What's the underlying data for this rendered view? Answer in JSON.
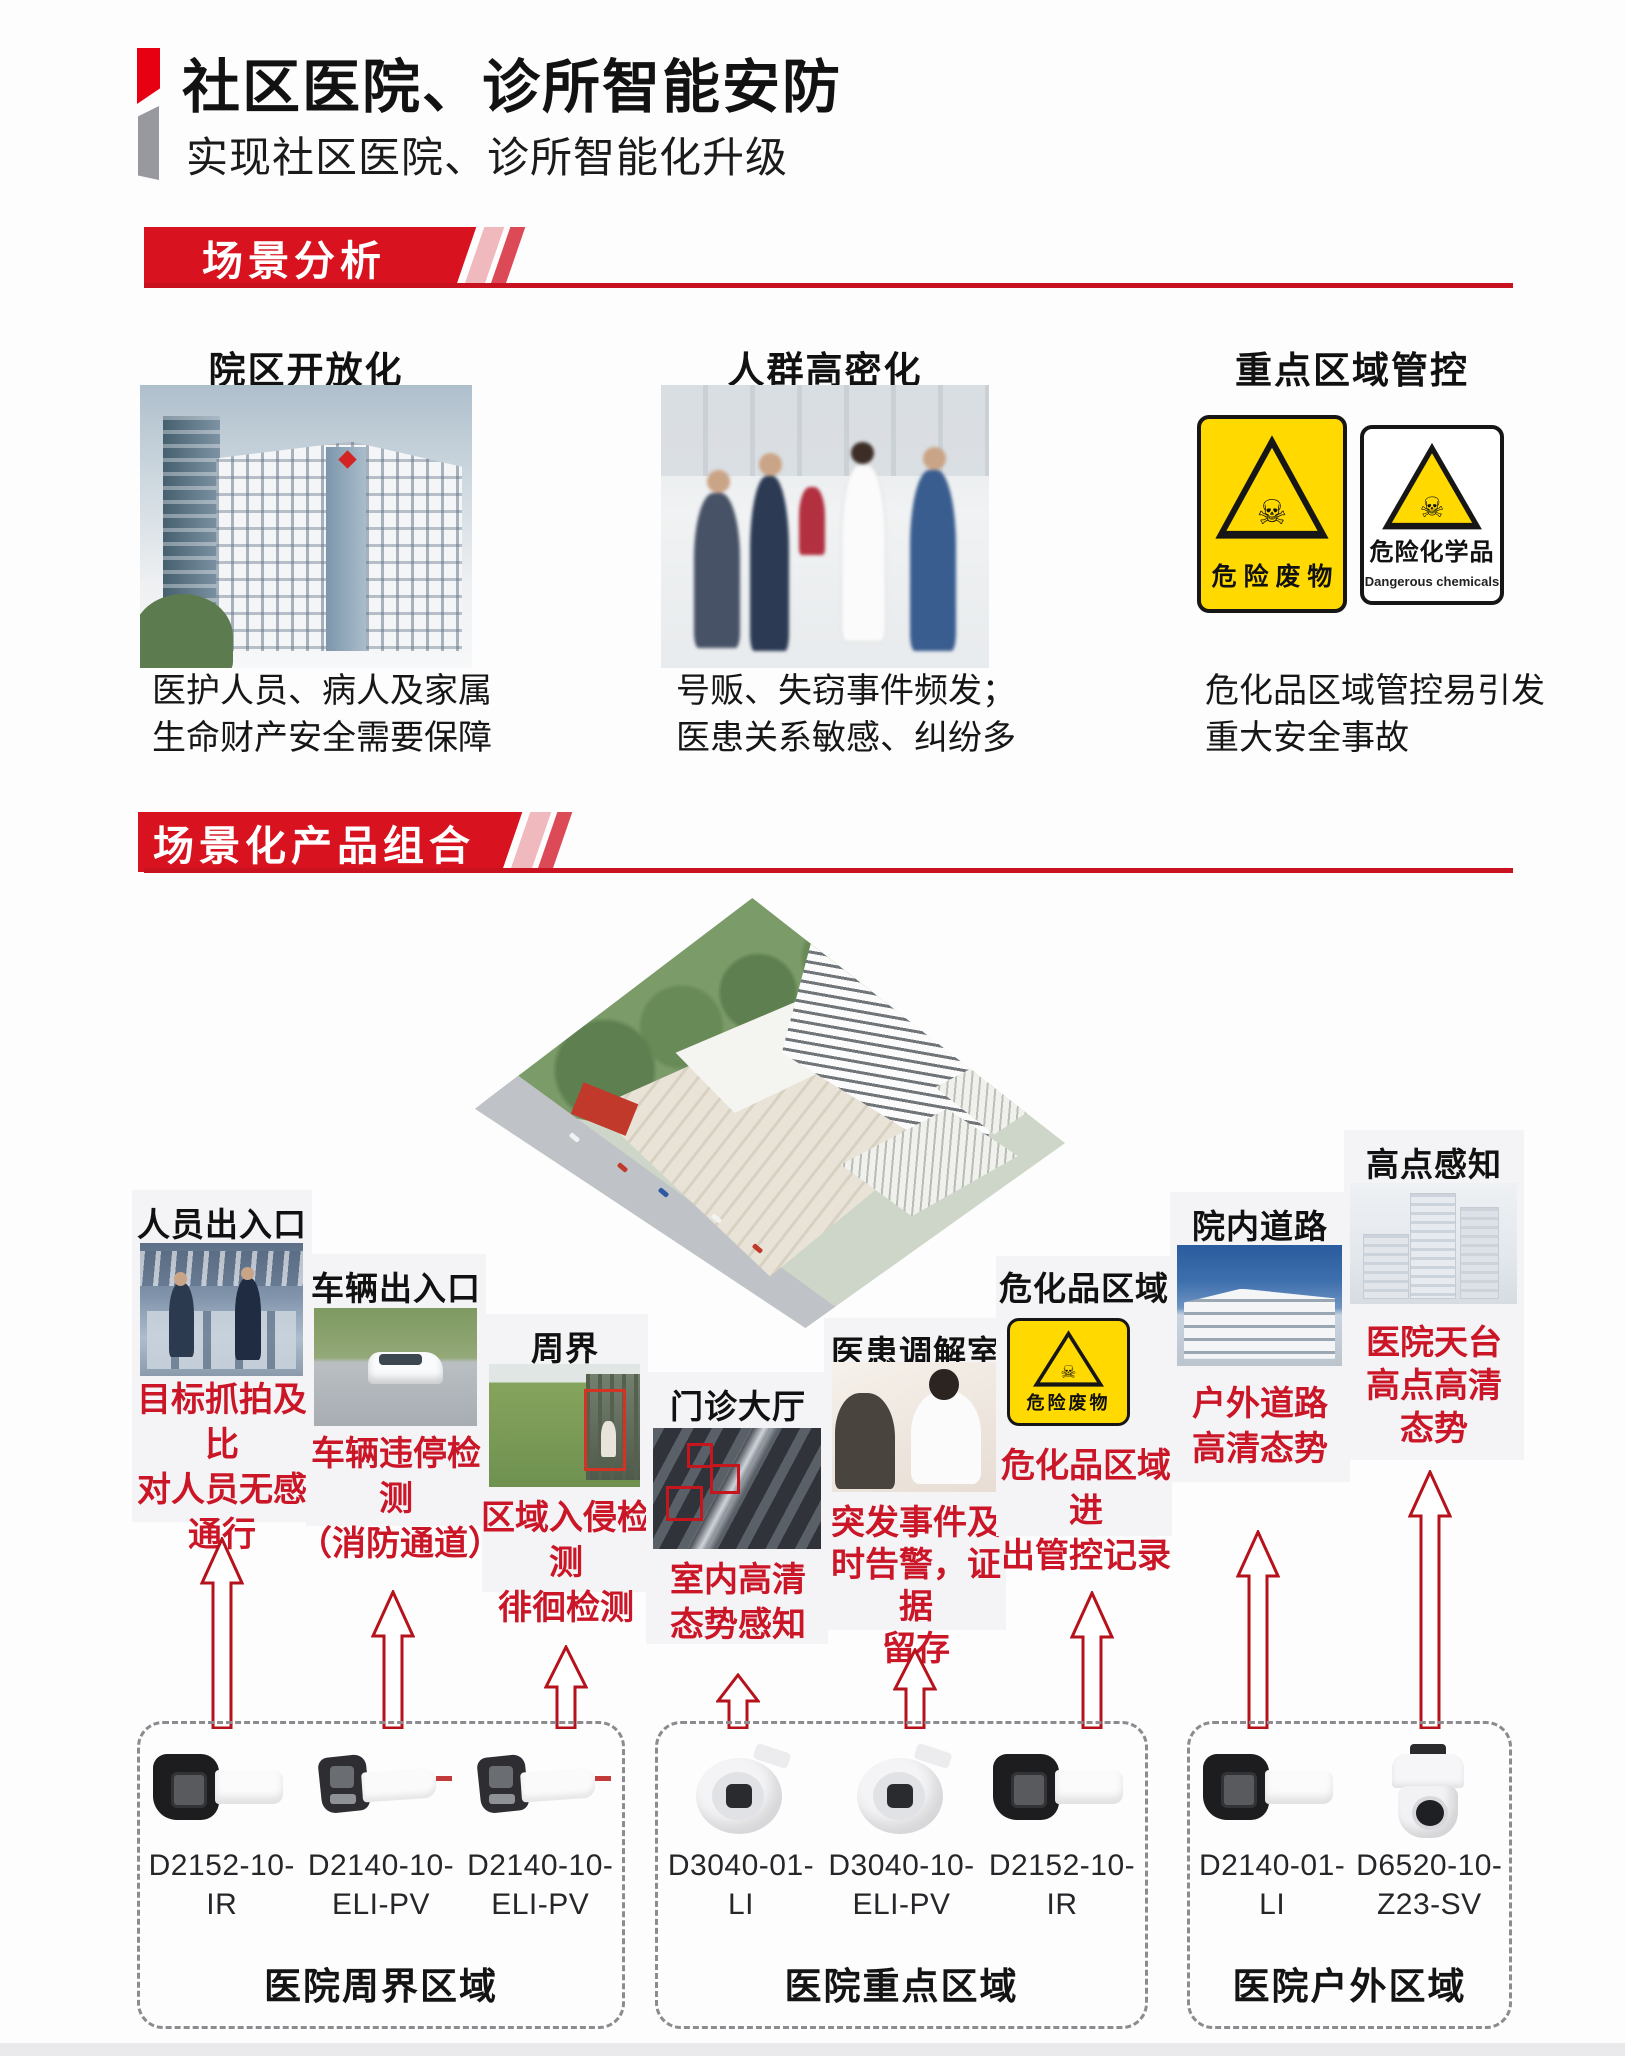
{
  "page": {
    "title": "社区医院、诊所智能安防",
    "subtitle": "实现社区医院、诊所智能化升级"
  },
  "scene_analysis": {
    "banner_label": "场景分析",
    "columns": [
      {
        "title": "院区开放化",
        "photo": "hospital-building",
        "caption_lines": [
          "医护人员、病人及家属",
          "生命财产安全需要保障"
        ]
      },
      {
        "title": "人群高密化",
        "photo": "crowded-lobby",
        "caption_lines": [
          "号贩、失窃事件频发；",
          "医患关系敏感、纠纷多"
        ]
      },
      {
        "title": "重点区域管控",
        "photo": "hazard-signs",
        "caption_lines": [
          "危化品区域管控易引发",
          "重大安全事故"
        ],
        "signs": [
          {
            "label": "危 险 废 物"
          },
          {
            "label": "危险化学品",
            "sublabel": "Dangerous chemicals"
          }
        ]
      }
    ]
  },
  "product_combo": {
    "banner_label": "场景化产品组合",
    "scenarios": [
      {
        "title": "人员出入口",
        "notes": [
          "目标抓拍及比",
          "对人员无感",
          "通行"
        ]
      },
      {
        "title": "车辆出入口",
        "notes": [
          "车辆违停检测",
          "（消防通道）"
        ]
      },
      {
        "title": "周界",
        "notes": [
          "区域入侵检测",
          "徘徊检测"
        ]
      },
      {
        "title": "门诊大厅",
        "notes": [
          "室内高清",
          "态势感知"
        ]
      },
      {
        "title": "医患调解室",
        "notes": [
          "突发事件及",
          "时告警，证据",
          "留存"
        ]
      },
      {
        "title": "危化品区域",
        "sign_label": "危险废物",
        "notes": [
          "危化品区域进",
          "出管控记录"
        ]
      },
      {
        "title": "院内道路",
        "notes": [
          "户外道路",
          "高清态势"
        ]
      },
      {
        "title": "高点感知",
        "notes": [
          "医院天台",
          "高点高清",
          "态势"
        ]
      }
    ],
    "groups": [
      {
        "label": "医院周界区域",
        "cameras": [
          {
            "model": "D2152-10-IR",
            "model_lines": [
              "D2152-10-IR"
            ],
            "icon": "bullet-camera-dark"
          },
          {
            "model": "D2140-10-ELI-PV",
            "model_lines": [
              "D2140-10-",
              "ELI-PV"
            ],
            "icon": "bullet-camera-white"
          },
          {
            "model": "D2140-10-ELI-PV",
            "model_lines": [
              "D2140-10-",
              "ELI-PV"
            ],
            "icon": "bullet-camera-white"
          }
        ]
      },
      {
        "label": "医院重点区域",
        "cameras": [
          {
            "model": "D3040-01-LI",
            "model_lines": [
              "D3040-01-LI"
            ],
            "icon": "turret-camera"
          },
          {
            "model": "D3040-10-ELI-PV",
            "model_lines": [
              "D3040-10-",
              "ELI-PV"
            ],
            "icon": "turret-camera"
          },
          {
            "model": "D2152-10-IR",
            "model_lines": [
              "D2152-10-IR"
            ],
            "icon": "bullet-camera-dark"
          }
        ]
      },
      {
        "label": "医院户外区域",
        "cameras": [
          {
            "model": "D2140-01-LI",
            "model_lines": [
              "D2140-01-LI"
            ],
            "icon": "bullet-camera-dark"
          },
          {
            "model": "D6520-10-Z23-SV",
            "model_lines": [
              "D6520-10-",
              "Z23-SV"
            ],
            "icon": "ptz-camera"
          }
        ]
      }
    ]
  },
  "colors": {
    "banner_red": "#d8131f",
    "accent_red": "#e60012",
    "accent_gray": "#97999e",
    "note_red": "#cb1628",
    "arrow_red": "#b5121b",
    "sign_yellow": "#ffd900"
  }
}
